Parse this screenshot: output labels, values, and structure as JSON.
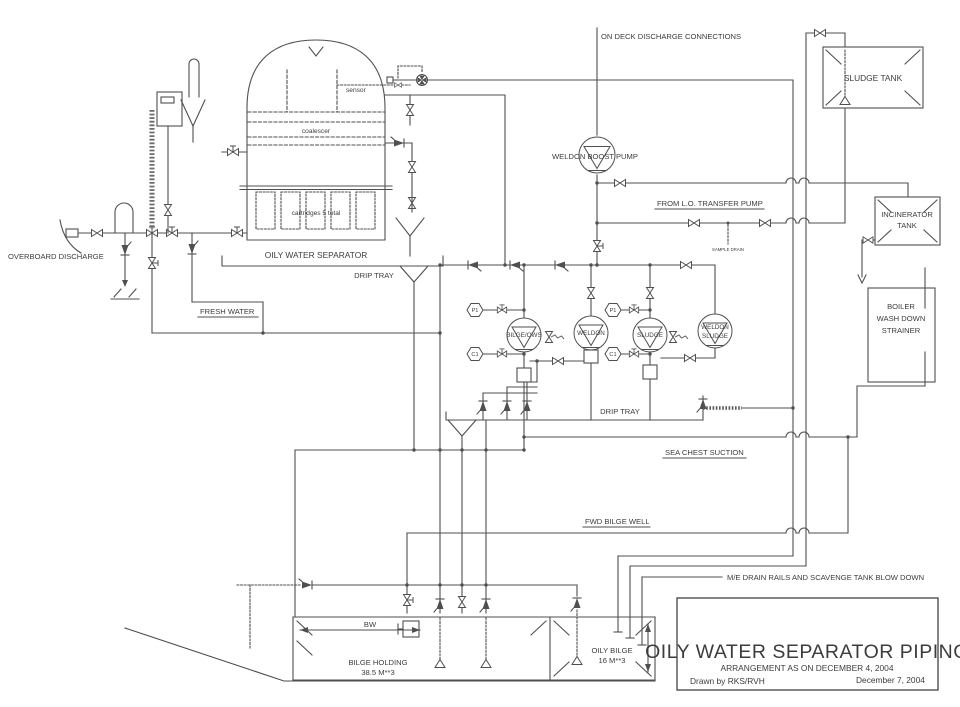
{
  "diagram": {
    "labels": {
      "overboard_discharge": "OVERBOARD DISCHARGE",
      "fresh_water": "FRESH WATER",
      "sensor": "sensor",
      "coalescer": "coalescer",
      "cartridges": "cartridges 5 total",
      "oily_water_separator": "OILY WATER SEPARATOR",
      "drip_tray_upper": "DRIP TRAY",
      "drip_tray_lower": "DRIP TRAY",
      "on_deck": "ON DECK DISCHARGE CONNECTIONS",
      "sludge_tank": "SLUDGE TANK",
      "weldon_boost_pump": "WELDON BOOST PUMP",
      "from_lo_transfer_pump": "FROM L.O. TRANSFER PUMP",
      "sample_drain": "SAMPLE DRAIN",
      "incinerator_line1": "INCINERATOR",
      "incinerator_line2": "TANK",
      "boiler_line1": "BOILER",
      "boiler_line2": "WASH DOWN",
      "boiler_line3": "STRAINER",
      "pump_bilge_ows": "BILGE/OWS",
      "pump_weldon": "WELDON",
      "pump_sludge": "SLUDGE",
      "pump_weldon_sludge_line1": "WELDON",
      "pump_weldon_sludge_line2": "SLUDGE",
      "gauge_p1": "P1",
      "gauge_c1": "C1",
      "sea_chest_suction": "SEA CHEST SUCTION",
      "fwd_bilge_well": "FWD BILGE WELL",
      "me_drain_rails": "M/E DRAIN RAILS AND SCAVENGE TANK BLOW DOWN",
      "bw": "BW",
      "bilge_holding_line1": "BILGE HOLDING",
      "bilge_holding_line2": "38.5 M**3",
      "oily_bilge_line1": "OILY BILGE",
      "oily_bilge_line2": "16 M**3"
    },
    "title_block": {
      "title": "OILY WATER SEPARATOR PIPING",
      "subtitle": "ARRANGEMENT AS ON DECEMBER 4, 2004",
      "drawn_by": "Drawn by RKS/RVH",
      "date": "December 7, 2004"
    },
    "colors": {
      "line": "#4f4f4f",
      "text": "#3c3c3c",
      "background": "#ffffff"
    }
  }
}
